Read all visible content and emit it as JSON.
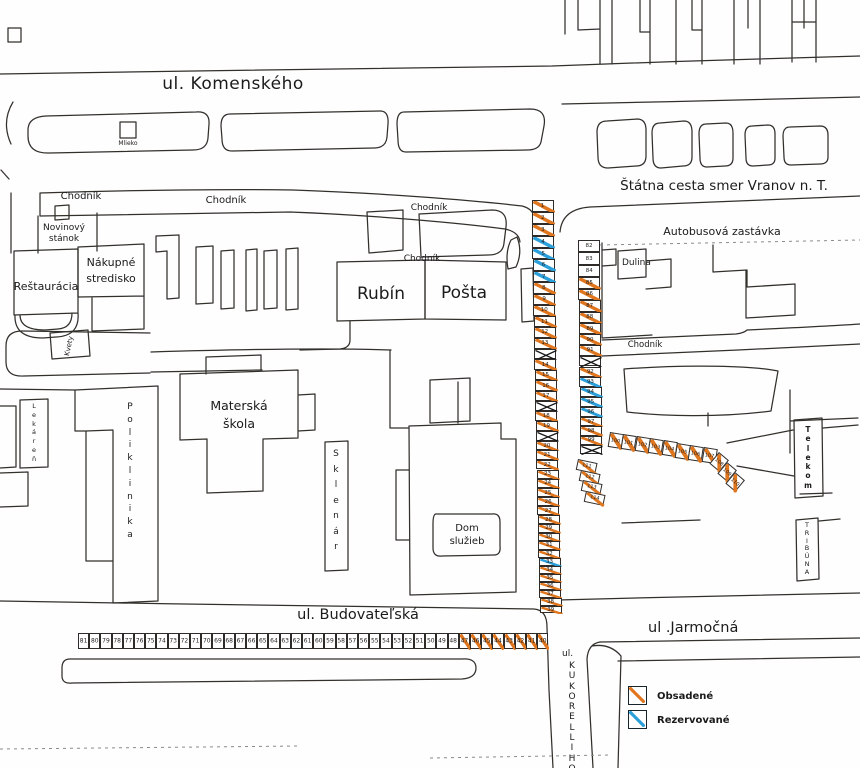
{
  "streets": {
    "komenskeho": "ul. Komenského",
    "statna_cesta": "Štátna cesta smer Vranov n. T.",
    "budovatelska": "ul. Budovateľská",
    "jarmocna": "ul .Jarmočná",
    "kukorelliho_prefix": "ul.",
    "kukorelliho": "KUKORELLIHO"
  },
  "areas": {
    "autobusova": "Autobusová zastávka",
    "chodnik": "Chodník",
    "dulina": "Dulina"
  },
  "buildings": {
    "mlieko": "Mlieko",
    "novinovy_1": "Novinový",
    "novinovy_2": "stánok",
    "restauracia": "Reštaurácia",
    "nakupne_1": "Nákupné",
    "nakupne_2": "stredisko",
    "rubin": "Rubín",
    "posta": "Pošta",
    "materska_1": "Materská",
    "materska_2": "škola",
    "dom_sluzieb_1": "Dom",
    "dom_sluzieb_2": "služieb",
    "lekaren": "Lekáreň",
    "poliklinika": "Poliklinika",
    "sklenar": "Sklenár",
    "kvety": "Kvety",
    "telekom": "Telekom",
    "tribuna": "TRIBÚNA"
  },
  "legend": {
    "occupied_label": "Obsadené",
    "reserved_label": "Rezervované"
  },
  "colors": {
    "occupied": "#e0761e",
    "reserved": "#2b9fd9",
    "crossed": "#161616",
    "line": "#33302c"
  },
  "stalls": {
    "left_strip": [
      {
        "n": "1",
        "s": "o"
      },
      {
        "n": "2",
        "s": "o"
      },
      {
        "n": "3",
        "s": "o"
      },
      {
        "n": "4",
        "s": "r"
      },
      {
        "n": "5",
        "s": "r"
      },
      {
        "n": "6",
        "s": "r"
      },
      {
        "n": "7",
        "s": "r"
      },
      {
        "n": "8",
        "s": "o"
      },
      {
        "n": "9",
        "s": "o"
      },
      {
        "n": "10",
        "s": "o"
      },
      {
        "n": "11",
        "s": "o"
      },
      {
        "n": "12",
        "s": "o"
      },
      {
        "n": "13",
        "s": "o"
      },
      {
        "n": "",
        "s": "x"
      },
      {
        "n": "14",
        "s": "o"
      },
      {
        "n": "15",
        "s": "o"
      },
      {
        "n": "16",
        "s": "o"
      },
      {
        "n": "17",
        "s": "o"
      },
      {
        "n": "",
        "s": "x"
      },
      {
        "n": "18",
        "s": "o"
      },
      {
        "n": "19",
        "s": "o"
      },
      {
        "n": "",
        "s": "x"
      },
      {
        "n": "20",
        "s": "o"
      },
      {
        "n": "21",
        "s": "o"
      },
      {
        "n": "22",
        "s": "o"
      },
      {
        "n": "23",
        "s": "o"
      },
      {
        "n": "24",
        "s": "o"
      },
      {
        "n": "25",
        "s": "o"
      },
      {
        "n": "26",
        "s": "o"
      },
      {
        "n": "27",
        "s": "o"
      },
      {
        "n": "28",
        "s": "o"
      },
      {
        "n": "29",
        "s": "o"
      },
      {
        "n": "30",
        "s": "o"
      },
      {
        "n": "31",
        "s": "o"
      },
      {
        "n": "32",
        "s": "o"
      },
      {
        "n": "33",
        "s": "r"
      },
      {
        "n": "34",
        "s": "o"
      },
      {
        "n": "35",
        "s": "o"
      },
      {
        "n": "36",
        "s": "o"
      },
      {
        "n": "37",
        "s": "o"
      },
      {
        "n": "38",
        "s": "o"
      },
      {
        "n": "39",
        "s": "o"
      }
    ],
    "bottom_row": [
      {
        "n": "81",
        "s": "f"
      },
      {
        "n": "80",
        "s": "f"
      },
      {
        "n": "79",
        "s": "f"
      },
      {
        "n": "78",
        "s": "f"
      },
      {
        "n": "77",
        "s": "f"
      },
      {
        "n": "76",
        "s": "f"
      },
      {
        "n": "75",
        "s": "f"
      },
      {
        "n": "74",
        "s": "f"
      },
      {
        "n": "73",
        "s": "f"
      },
      {
        "n": "72",
        "s": "f"
      },
      {
        "n": "71",
        "s": "f"
      },
      {
        "n": "70",
        "s": "f"
      },
      {
        "n": "69",
        "s": "f"
      },
      {
        "n": "68",
        "s": "f"
      },
      {
        "n": "67",
        "s": "f"
      },
      {
        "n": "66",
        "s": "f"
      },
      {
        "n": "65",
        "s": "f"
      },
      {
        "n": "64",
        "s": "f"
      },
      {
        "n": "63",
        "s": "f"
      },
      {
        "n": "62",
        "s": "f"
      },
      {
        "n": "61",
        "s": "f"
      },
      {
        "n": "60",
        "s": "f"
      },
      {
        "n": "59",
        "s": "f"
      },
      {
        "n": "58",
        "s": "f"
      },
      {
        "n": "57",
        "s": "f"
      },
      {
        "n": "56",
        "s": "f"
      },
      {
        "n": "55",
        "s": "f"
      },
      {
        "n": "54",
        "s": "f"
      },
      {
        "n": "53",
        "s": "f"
      },
      {
        "n": "52",
        "s": "f"
      },
      {
        "n": "51",
        "s": "f"
      },
      {
        "n": "50",
        "s": "f"
      },
      {
        "n": "49",
        "s": "f"
      },
      {
        "n": "48",
        "s": "f"
      },
      {
        "n": "47",
        "s": "o"
      },
      {
        "n": "46",
        "s": "o"
      },
      {
        "n": "45",
        "s": "o"
      },
      {
        "n": "44",
        "s": "o"
      },
      {
        "n": "43",
        "s": "o"
      },
      {
        "n": "42",
        "s": "o"
      },
      {
        "n": "41",
        "s": "o"
      },
      {
        "n": "40",
        "s": "o"
      }
    ],
    "right_strip": [
      {
        "n": "82",
        "s": "f"
      },
      {
        "n": "83",
        "s": "f"
      },
      {
        "n": "84",
        "s": "f"
      },
      {
        "n": "85",
        "s": "o"
      },
      {
        "n": "86",
        "s": "o"
      },
      {
        "n": "87",
        "s": "o"
      },
      {
        "n": "88",
        "s": "o"
      },
      {
        "n": "89",
        "s": "o"
      },
      {
        "n": "90",
        "s": "o"
      },
      {
        "n": "91",
        "s": "o"
      },
      {
        "n": "",
        "s": "x"
      },
      {
        "n": "92",
        "s": "o"
      },
      {
        "n": "93",
        "s": "r"
      },
      {
        "n": "94",
        "s": "r"
      },
      {
        "n": "95",
        "s": "r"
      },
      {
        "n": "96",
        "s": "r"
      },
      {
        "n": "97",
        "s": "o"
      },
      {
        "n": "98",
        "s": "o"
      },
      {
        "n": "99",
        "s": "o"
      },
      {
        "n": "",
        "s": "x"
      }
    ],
    "row_horizontal": [
      {
        "n": "100",
        "s": "o"
      },
      {
        "n": "101",
        "s": "o"
      },
      {
        "n": "102",
        "s": "o"
      },
      {
        "n": "103",
        "s": "o"
      },
      {
        "n": "104",
        "s": "o"
      },
      {
        "n": "105",
        "s": "o"
      },
      {
        "n": "106",
        "s": "o"
      },
      {
        "n": "107",
        "s": "o"
      }
    ],
    "row_diagonal": [
      {
        "n": "108",
        "s": "o"
      },
      {
        "n": "109",
        "s": "o"
      },
      {
        "n": "110",
        "s": "o"
      }
    ],
    "right_lower": [
      {
        "n": "111",
        "s": "o"
      },
      {
        "n": "112",
        "s": "o"
      },
      {
        "n": "113",
        "s": "o"
      },
      {
        "n": "114",
        "s": "o"
      }
    ]
  }
}
